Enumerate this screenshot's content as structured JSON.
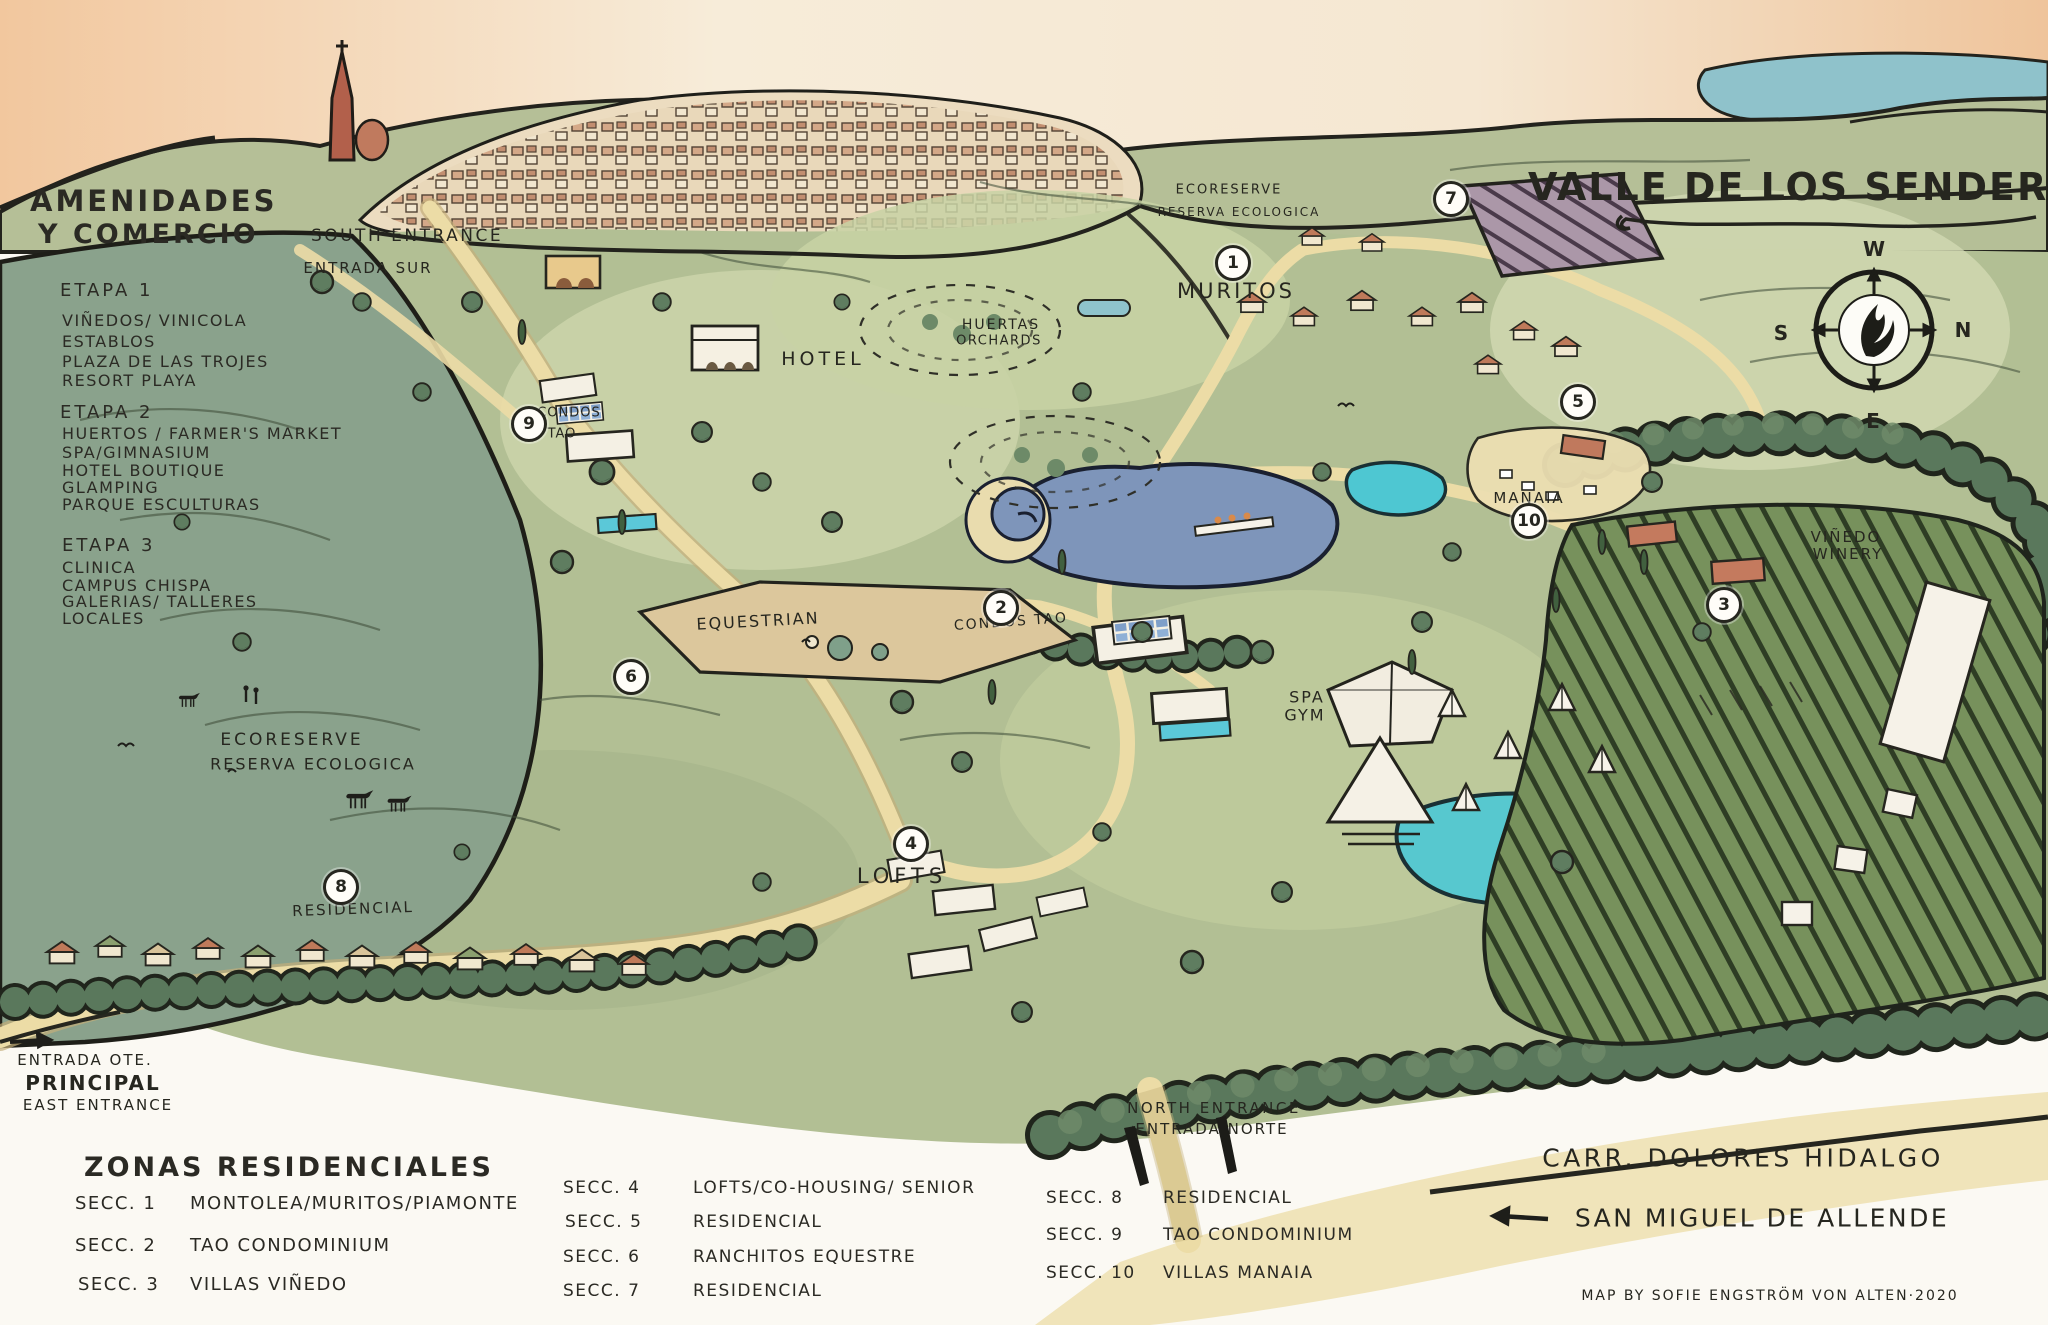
{
  "title": "VALLE DE LOS SENDEROS",
  "credit": "MAP BY SOFIE ENGSTRÖM VON ALTEN·2020",
  "compass": {
    "top": "W",
    "right": "N",
    "left": "S",
    "bottom": "E"
  },
  "colors": {
    "ink": "#26261f",
    "paper": "#fbf9f3",
    "field_green": "#b2bf94",
    "slope_green": "#8aa28c",
    "road_cream": "#ecdca6",
    "lake_blue": "#7e95ba",
    "pond_turquoise": "#4ec7d2",
    "terracotta": "#bf7a5a",
    "sky_peach": "#f2c79e",
    "hedge_green": "#5a785c"
  },
  "amenities_legend": {
    "heading_line1": "AMENIDADES",
    "heading_line2": "Y COMERCIO",
    "etapa1_title": "ETAPA 1",
    "etapa1_items": [
      "VIÑEDOS/ VINICOLA",
      "ESTABLOS",
      "PLAZA DE LAS TROJES",
      "RESORT PLAYA"
    ],
    "etapa2_title": "ETAPA 2",
    "etapa2_items": [
      "HUERTOS / FARMER'S MARKET",
      "SPA/GIMNASIUM",
      "HOTEL BOUTIQUE",
      "GLAMPING",
      "PARQUE ESCULTURAS"
    ],
    "etapa3_title": "ETAPA 3",
    "etapa3_items": [
      "CLINICA",
      "CAMPUS CHISPA",
      "GALERIAS/ TALLERES",
      "LOCALES"
    ]
  },
  "zones_legend": {
    "heading": "ZONAS RESIDENCIALES",
    "col1": [
      {
        "label": "SECC. 1",
        "desc": "MONTOLEA/MURITOS/PIAMONTE"
      },
      {
        "label": "SECC. 2",
        "desc": "TAO CONDOMINIUM"
      },
      {
        "label": "SECC. 3",
        "desc": "VILLAS VIÑEDO"
      }
    ],
    "col2": [
      {
        "label": "SECC. 4",
        "desc": "LOFTS/CO-HOUSING/ SENIOR"
      },
      {
        "label": "SECC. 5",
        "desc": "RESIDENCIAL"
      },
      {
        "label": "SECC. 6",
        "desc": "RANCHITOS EQUESTRE"
      },
      {
        "label": "SECC. 7",
        "desc": "RESIDENCIAL"
      }
    ],
    "col3": [
      {
        "label": "SECC. 8",
        "desc": "RESIDENCIAL"
      },
      {
        "label": "SECC. 9",
        "desc": "TAO CONDOMINIUM"
      },
      {
        "label": "SECC. 10",
        "desc": "VILLAS MANAIA"
      }
    ]
  },
  "map_labels": {
    "south_entrance_en": "SOUTH ENTRANCE",
    "south_entrance_es": "ENTRADA SUR",
    "condos9_l1": "CONDOS",
    "condos9_l2": "TAO",
    "hotel": "HOTEL",
    "huertas_l1": "HUERTAS",
    "huertas_l2": "ORCHARDS",
    "eco_top_l1": "ECORESERVE",
    "eco_top_l2": "RESERVA ECOLOGICA",
    "muritos": "MURITOS",
    "manaia": "MANAIA",
    "vinedo_l1": "VIÑEDO",
    "vinedo_l2": "WINERY",
    "condos_tao_2": "CONDOS TAO",
    "equestrian": "EQUESTRIAN",
    "spa_l1": "SPA",
    "spa_l2": "GYM",
    "eco_left_l1": "ECORESERVE",
    "eco_left_l2": "RESERVA ECOLOGICA",
    "lofts": "LOFTS",
    "residencial": "RESIDENCIAL",
    "east_l1": "ENTRADA OTE.",
    "east_l2": "PRINCIPAL",
    "east_l3": "EAST ENTRANCE",
    "north_l1": "NORTH ENTRANCE",
    "north_l2": "ENTRADA NORTE",
    "carr_dolores": "CARR. DOLORES HIDALGO",
    "san_miguel": "SAN MIGUEL DE ALLENDE"
  },
  "markers": [
    "1",
    "2",
    "3",
    "4",
    "5",
    "6",
    "7",
    "8",
    "9",
    "10"
  ]
}
